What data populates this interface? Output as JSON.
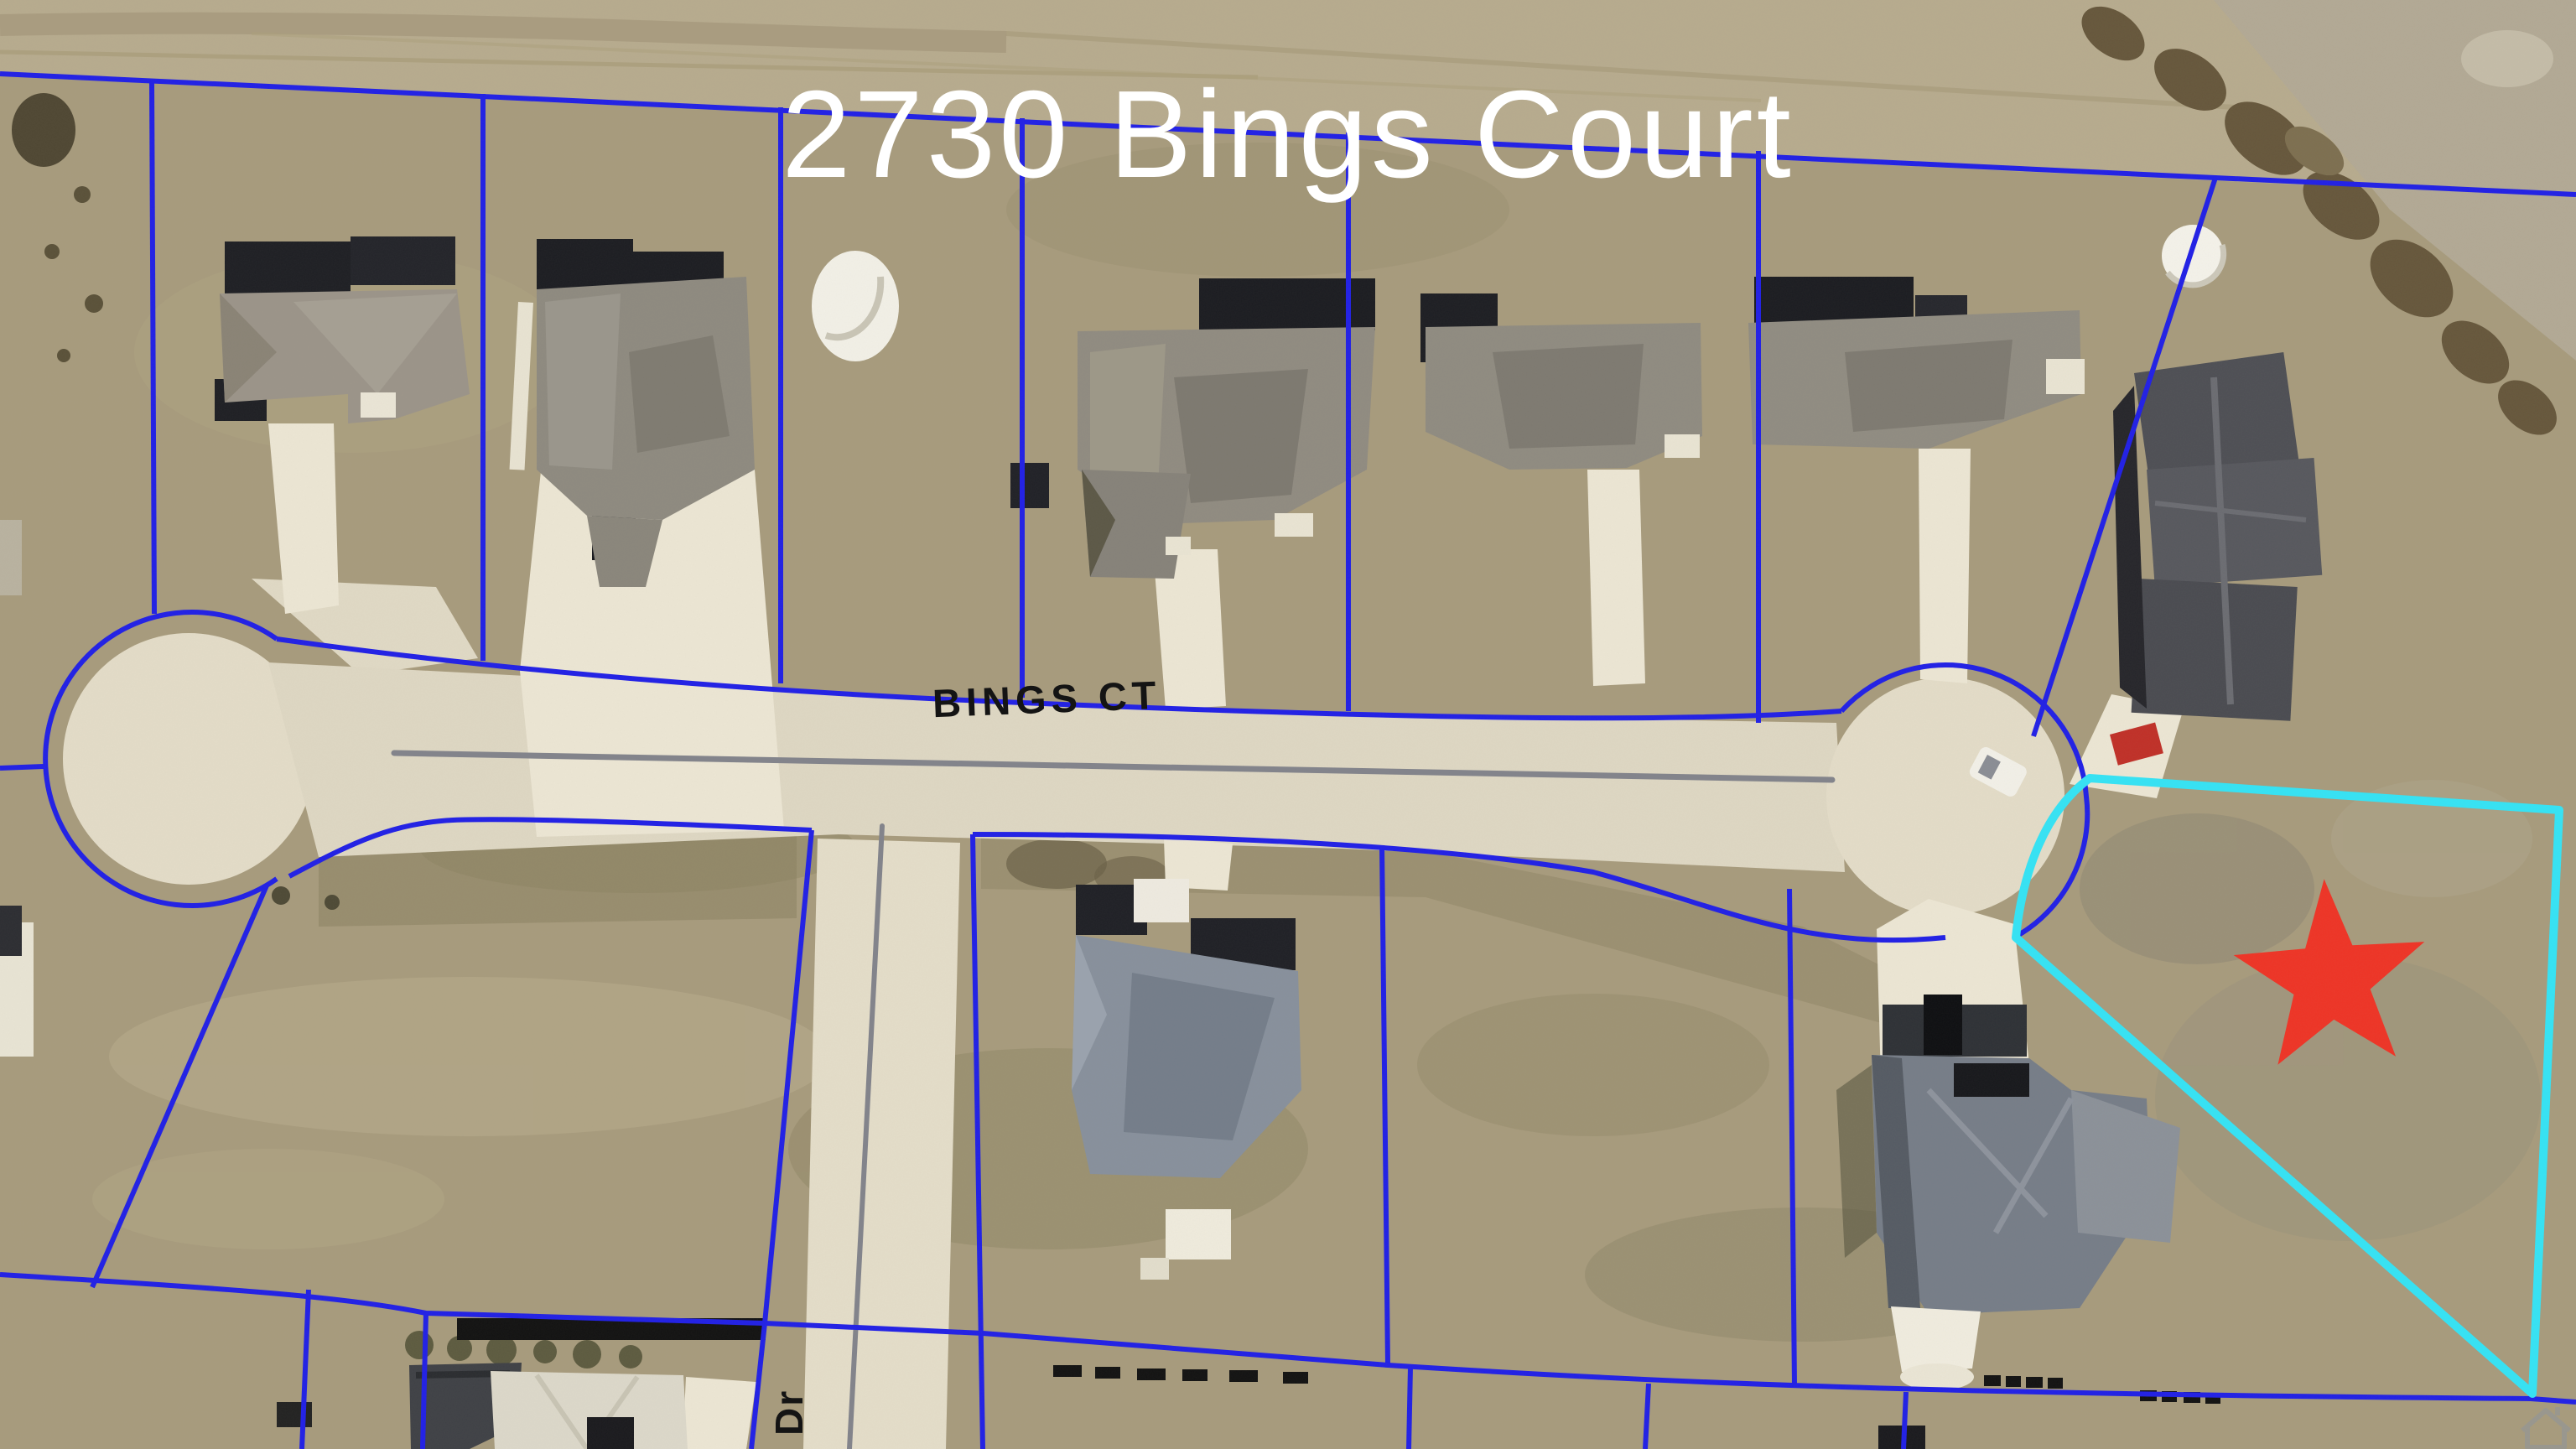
{
  "map": {
    "title": "2730 Bings Court",
    "type": "aerial-parcel-map",
    "subject_parcel": {
      "address": "2730 Bings Court",
      "highlighted": true,
      "marker": "red-star"
    }
  },
  "labels": {
    "title": "2730 Bings Court",
    "bings_ct": "BINGS CT",
    "dr": "Dr"
  },
  "marker": {
    "shape": "5-point-star",
    "points": 5
  },
  "colors": {
    "parcel_line_blue": "#2120e6",
    "highlight_cyan": "#35e3f5",
    "marker_red": "#ee3426",
    "title_white": "#ffffff",
    "road_label_black": "#141414",
    "pavement": "#ded7c3",
    "field_tan": "#a79b7d"
  },
  "watermark": {
    "icon": "house-icon"
  }
}
